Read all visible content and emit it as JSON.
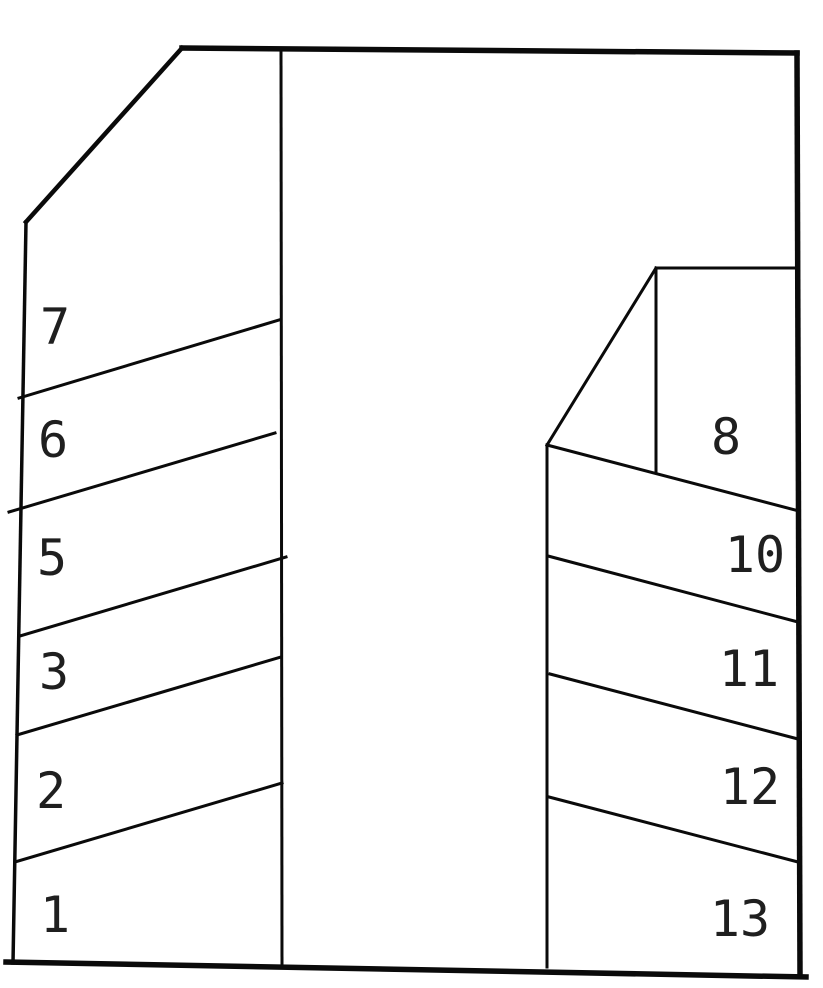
{
  "canvas": {
    "width": 823,
    "height": 988,
    "background": "#ffffff",
    "line_color": "#0a0a0a",
    "label_color": "#1f1f1f"
  },
  "diagram": {
    "type": "parking-lot-line-drawing",
    "stall_numbers_left": [
      "7",
      "6",
      "5",
      "3",
      "2",
      "1"
    ],
    "stall_numbers_right": [
      "8",
      "10",
      "11",
      "12",
      "13"
    ],
    "lines": [
      {
        "name": "outer-top-border",
        "x1": 182,
        "y1": 48,
        "x2": 797,
        "y2": 53,
        "w": 5.5
      },
      {
        "name": "outer-top-left-diagonal",
        "x1": 182,
        "y1": 48,
        "x2": 26,
        "y2": 222,
        "w": 4.5
      },
      {
        "name": "outer-left-border",
        "x1": 26,
        "y1": 222,
        "x2": 13,
        "y2": 963,
        "w": 3.5
      },
      {
        "name": "outer-bottom-border",
        "x1": 6,
        "y1": 962,
        "x2": 806,
        "y2": 977,
        "w": 5.5
      },
      {
        "name": "outer-right-border",
        "x1": 797,
        "y1": 53,
        "x2": 800,
        "y2": 975,
        "w": 5.5
      },
      {
        "name": "center-lane-divider",
        "x1": 281,
        "y1": 50,
        "x2": 282,
        "y2": 965,
        "w": 3
      },
      {
        "name": "stall-divider-7-6",
        "x1": 19,
        "y1": 398,
        "x2": 279,
        "y2": 320,
        "w": 3
      },
      {
        "name": "stall-divider-6-5",
        "x1": 9,
        "y1": 512,
        "x2": 275,
        "y2": 433,
        "w": 3
      },
      {
        "name": "stall-divider-5-3",
        "x1": 20,
        "y1": 636,
        "x2": 286,
        "y2": 557,
        "w": 3
      },
      {
        "name": "stall-divider-3-2",
        "x1": 17,
        "y1": 735,
        "x2": 281,
        "y2": 657,
        "w": 3
      },
      {
        "name": "stall-divider-2-1",
        "x1": 15,
        "y1": 862,
        "x2": 282,
        "y2": 783,
        "w": 3
      },
      {
        "name": "right-block-left-edge",
        "x1": 547,
        "y1": 445,
        "x2": 547,
        "y2": 967,
        "w": 3
      },
      {
        "name": "stall8-hypotenuse",
        "x1": 547,
        "y1": 445,
        "x2": 656,
        "y2": 268,
        "w": 3
      },
      {
        "name": "stall8-inner-vertical",
        "x1": 656,
        "y1": 268,
        "x2": 656,
        "y2": 473,
        "w": 3
      },
      {
        "name": "stall8-top-edge",
        "x1": 656,
        "y1": 268,
        "x2": 797,
        "y2": 268,
        "w": 3
      },
      {
        "name": "stall-divider-8-10",
        "x1": 547,
        "y1": 445,
        "x2": 799,
        "y2": 511,
        "w": 3
      },
      {
        "name": "stall-divider-10-11",
        "x1": 548,
        "y1": 556,
        "x2": 798,
        "y2": 622,
        "w": 3
      },
      {
        "name": "stall-divider-11-12",
        "x1": 550,
        "y1": 674,
        "x2": 798,
        "y2": 739,
        "w": 3
      },
      {
        "name": "stall-divider-12-13",
        "x1": 549,
        "y1": 797,
        "x2": 798,
        "y2": 862,
        "w": 3
      }
    ],
    "labels": [
      {
        "text": "7",
        "x": 55,
        "y": 327
      },
      {
        "text": "6",
        "x": 53,
        "y": 440
      },
      {
        "text": "5",
        "x": 52,
        "y": 558
      },
      {
        "text": "3",
        "x": 54,
        "y": 672
      },
      {
        "text": "2",
        "x": 51,
        "y": 791
      },
      {
        "text": "1",
        "x": 55,
        "y": 915
      },
      {
        "text": "8",
        "x": 726,
        "y": 437
      },
      {
        "text": "10",
        "x": 755,
        "y": 555
      },
      {
        "text": "11",
        "x": 749,
        "y": 669
      },
      {
        "text": "12",
        "x": 750,
        "y": 787
      },
      {
        "text": "13",
        "x": 740,
        "y": 919
      }
    ]
  }
}
